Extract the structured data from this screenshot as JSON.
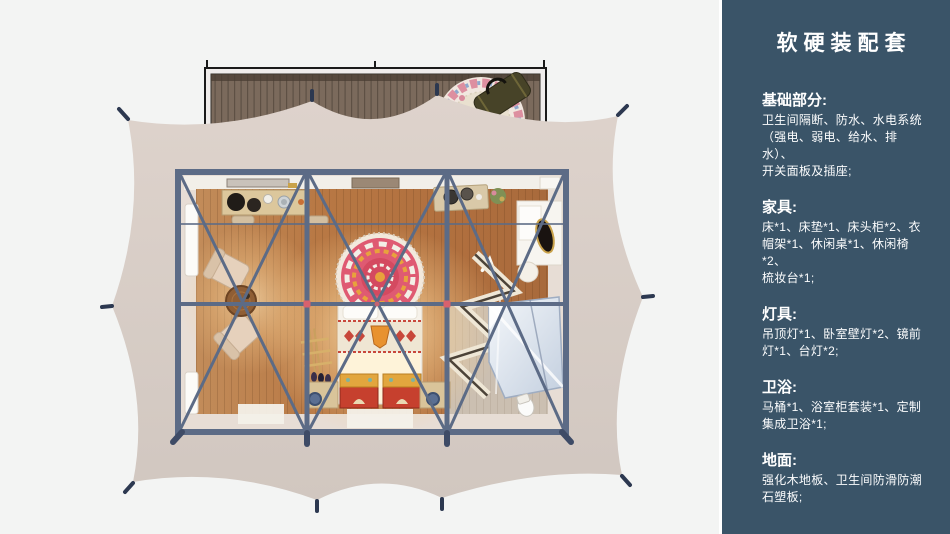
{
  "sidebar": {
    "title": "软硬装配套",
    "sections": [
      {
        "heading": "基础部分:",
        "body": "卫生间隔断、防水、水电系统\n（强电、弱电、给水、排水）、\n开关面板及插座;"
      },
      {
        "heading": "家具:",
        "body": "床*1、床垫*1、床头柜*2、衣\n帽架*1、休闲桌*1、休闲椅*2、\n梳妆台*1;"
      },
      {
        "heading": "灯具:",
        "body": "吊顶灯*1、卧室壁灯*2、镜前\n灯*1、台灯*2;"
      },
      {
        "heading": "卫浴:",
        "body": "马桶*1、浴室柜套装*1、定制\n集成卫浴*1;"
      },
      {
        "heading": "地面:",
        "body": "强化木地板、卫生间防滑防潮\n石塑板;"
      }
    ]
  },
  "colors": {
    "page-bg": "#f3f4f3",
    "sidebar-bg": "#3a5468",
    "sidebar-text": "#ffffff",
    "tent-canvas": "#d9cec7",
    "steel-frame": "#5c6b86",
    "wood-floor": "#b87844",
    "deck-wood": "#7b6a5c",
    "wall": "#e7ddd5",
    "chest-red": "#c6402e",
    "stake-navy": "#2c3850"
  }
}
